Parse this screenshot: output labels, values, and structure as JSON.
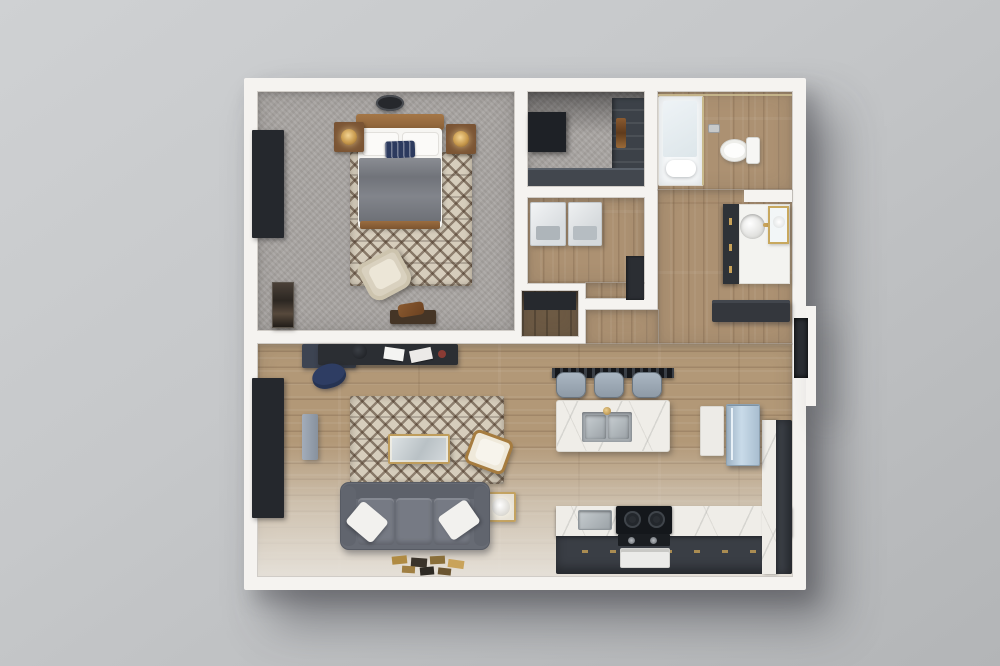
{
  "scene": {
    "type": "3D floor plan render",
    "view": "top-down dollhouse view",
    "subject": "one-bedroom apartment",
    "background_color": "#c6c8ca",
    "wall_color": "#f5f3f0"
  },
  "rooms": [
    {
      "name": "bedroom",
      "floor": "gray carpet",
      "items": [
        "ceiling-light",
        "double-bed with wood headboard, white pillows, navy accent pillow, gray duvet",
        "nightstand with brass lamp (left)",
        "nightstand with brass lamp (right)",
        "diamond-pattern area rug",
        "cream accent chair",
        "foot-of-bed bench with brown bag",
        "tall dark dresser / wall art",
        "black-framed window"
      ]
    },
    {
      "name": "walk-in-closet",
      "floor": "gray carpet",
      "items": [
        "dark wardrobe unit",
        "shelving column with clothes",
        "low cabinet run"
      ]
    },
    {
      "name": "laundry-room",
      "floor": "wood plank",
      "items": [
        "washer",
        "dryer",
        "dark utility cabinet"
      ]
    },
    {
      "name": "pantry-closet",
      "floor": "dark wood",
      "items": [
        "built-in shelf"
      ]
    },
    {
      "name": "bathroom",
      "floor": "wood plank",
      "items": [
        "glass walk-in shower with white towel",
        "toilet",
        "ceiling light"
      ]
    },
    {
      "name": "vanity-hallway",
      "floor": "wood plank",
      "items": [
        "dark vanity cabinet with brass pulls",
        "white counter with round sink and brass faucet",
        "gold-framed mirror",
        "dark entry console",
        "wall niche"
      ]
    },
    {
      "name": "living-room",
      "floor": "wood plank fading to light floor",
      "items": [
        "dark desk with white papers",
        "navy office chair",
        "black-framed window",
        "gray wall panel",
        "diamond-pattern area rug",
        "gold-framed glass coffee table",
        "gray three-seat sofa",
        "white throw pillow (left)",
        "white throw pillow (right)",
        "wood accent chair with white cushion",
        "gold side table with white lamp",
        "decorative books arranged on floor"
      ]
    },
    {
      "name": "kitchen",
      "floor": "wood plank",
      "items": [
        "white marble island with double stainless sink and brass faucet",
        "three bar stools with gray seats",
        "L-shaped dark counter with marble top and brass pulls",
        "range with black cooktop, knob panel and white oven door",
        "small stainless prep sink",
        "two-tone refrigerator",
        "tall white cabinet"
      ]
    }
  ],
  "counts": {
    "bar_stools": 3,
    "sofa_throw_pillows": 2,
    "windows": 2,
    "nightstands": 2,
    "laundry_appliances": 2,
    "bed_count": 1,
    "bathroom_count": 1
  },
  "palette": {
    "background": "#c6c8ca",
    "wall": "#f5f3f0",
    "carpet": "#a8a4a1",
    "wood": "#b29877",
    "rug_base": "#d6cdbc",
    "sofa_gray": "#676b74",
    "duvet_gray": "#7a7d84",
    "navy_accent": "#2c3a5e",
    "brass_gold": "#c8a258",
    "counter_dark": "#3a3e45",
    "marble": "#efede8",
    "fridge_steel_blue": "#aec3d6",
    "appliance_white": "#e9ebec",
    "window_frame": "#25282d",
    "glass": "#dde7ec"
  }
}
